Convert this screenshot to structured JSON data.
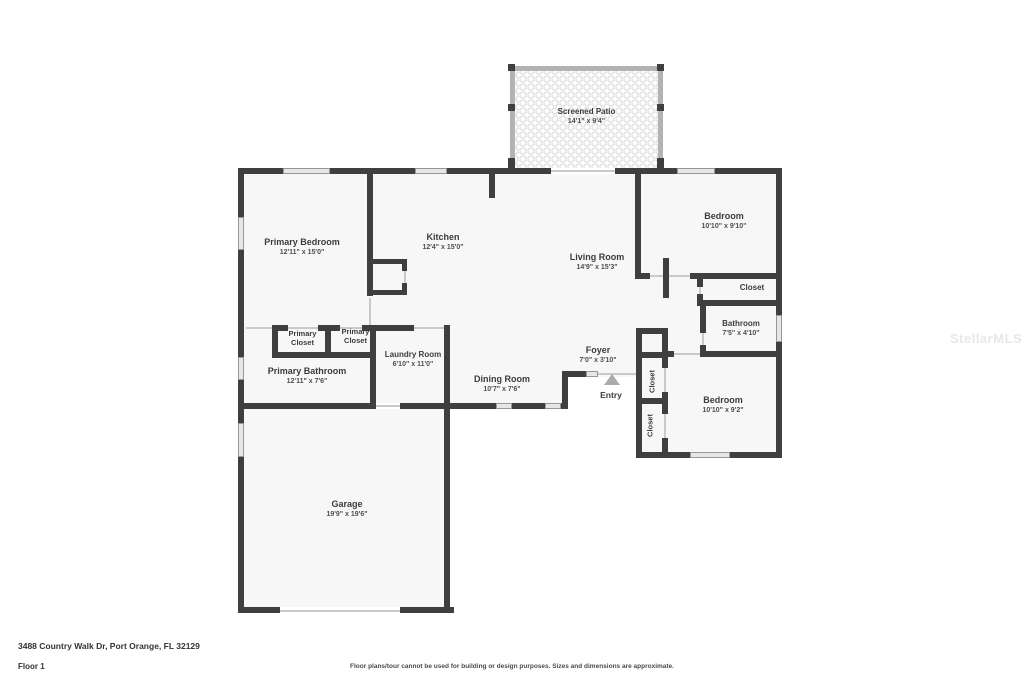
{
  "page": {
    "address": "3488 Country Walk Dr, Port Orange, FL 32129",
    "floor_label": "Floor 1",
    "disclaimer": "Floor plans/tour cannot be used for building or design purposes. Sizes and dimensions are approximate.",
    "watermark": "StellarMLS"
  },
  "rooms": {
    "screened_patio": {
      "name": "Screened Patio",
      "dims": "14'1\" x 9'4\""
    },
    "primary_bedroom": {
      "name": "Primary Bedroom",
      "dims": "12'11\" x 15'0\""
    },
    "kitchen": {
      "name": "Kitchen",
      "dims": "12'4\" x 15'0\""
    },
    "living_room": {
      "name": "Living Room",
      "dims": "14'9\" x 15'3\""
    },
    "bedroom_top": {
      "name": "Bedroom",
      "dims": "10'10\" x 9'10\""
    },
    "closet_top_right": {
      "name": "Closet"
    },
    "bathroom": {
      "name": "Bathroom",
      "dims": "7'5\" x 4'10\""
    },
    "primary_closet_left": {
      "name": "Primary Closet"
    },
    "primary_closet_right": {
      "name": "Primary Closet"
    },
    "primary_bathroom": {
      "name": "Primary Bathroom",
      "dims": "12'11\" x 7'6\""
    },
    "laundry_room": {
      "name": "Laundry Room",
      "dims": "6'10\" x 11'0\""
    },
    "dining_room": {
      "name": "Dining Room",
      "dims": "10'7\" x 7'6\""
    },
    "foyer": {
      "name": "Foyer",
      "dims": "7'0\" x 3'10\""
    },
    "closet_hall_upper": {
      "name": "Closet"
    },
    "closet_hall_lower": {
      "name": "Closet"
    },
    "bedroom_bottom": {
      "name": "Bedroom",
      "dims": "10'10\" x 9'2\""
    },
    "garage": {
      "name": "Garage",
      "dims": "19'9\" x 19'6\""
    },
    "entry": {
      "name": "Entry"
    }
  },
  "colors": {
    "wall": "#3f3f3f",
    "window_fill": "#e6e6e6",
    "floor": "#f7f7f8",
    "patio_wall": "#b3b3b3",
    "text": "#3c3c3c"
  }
}
